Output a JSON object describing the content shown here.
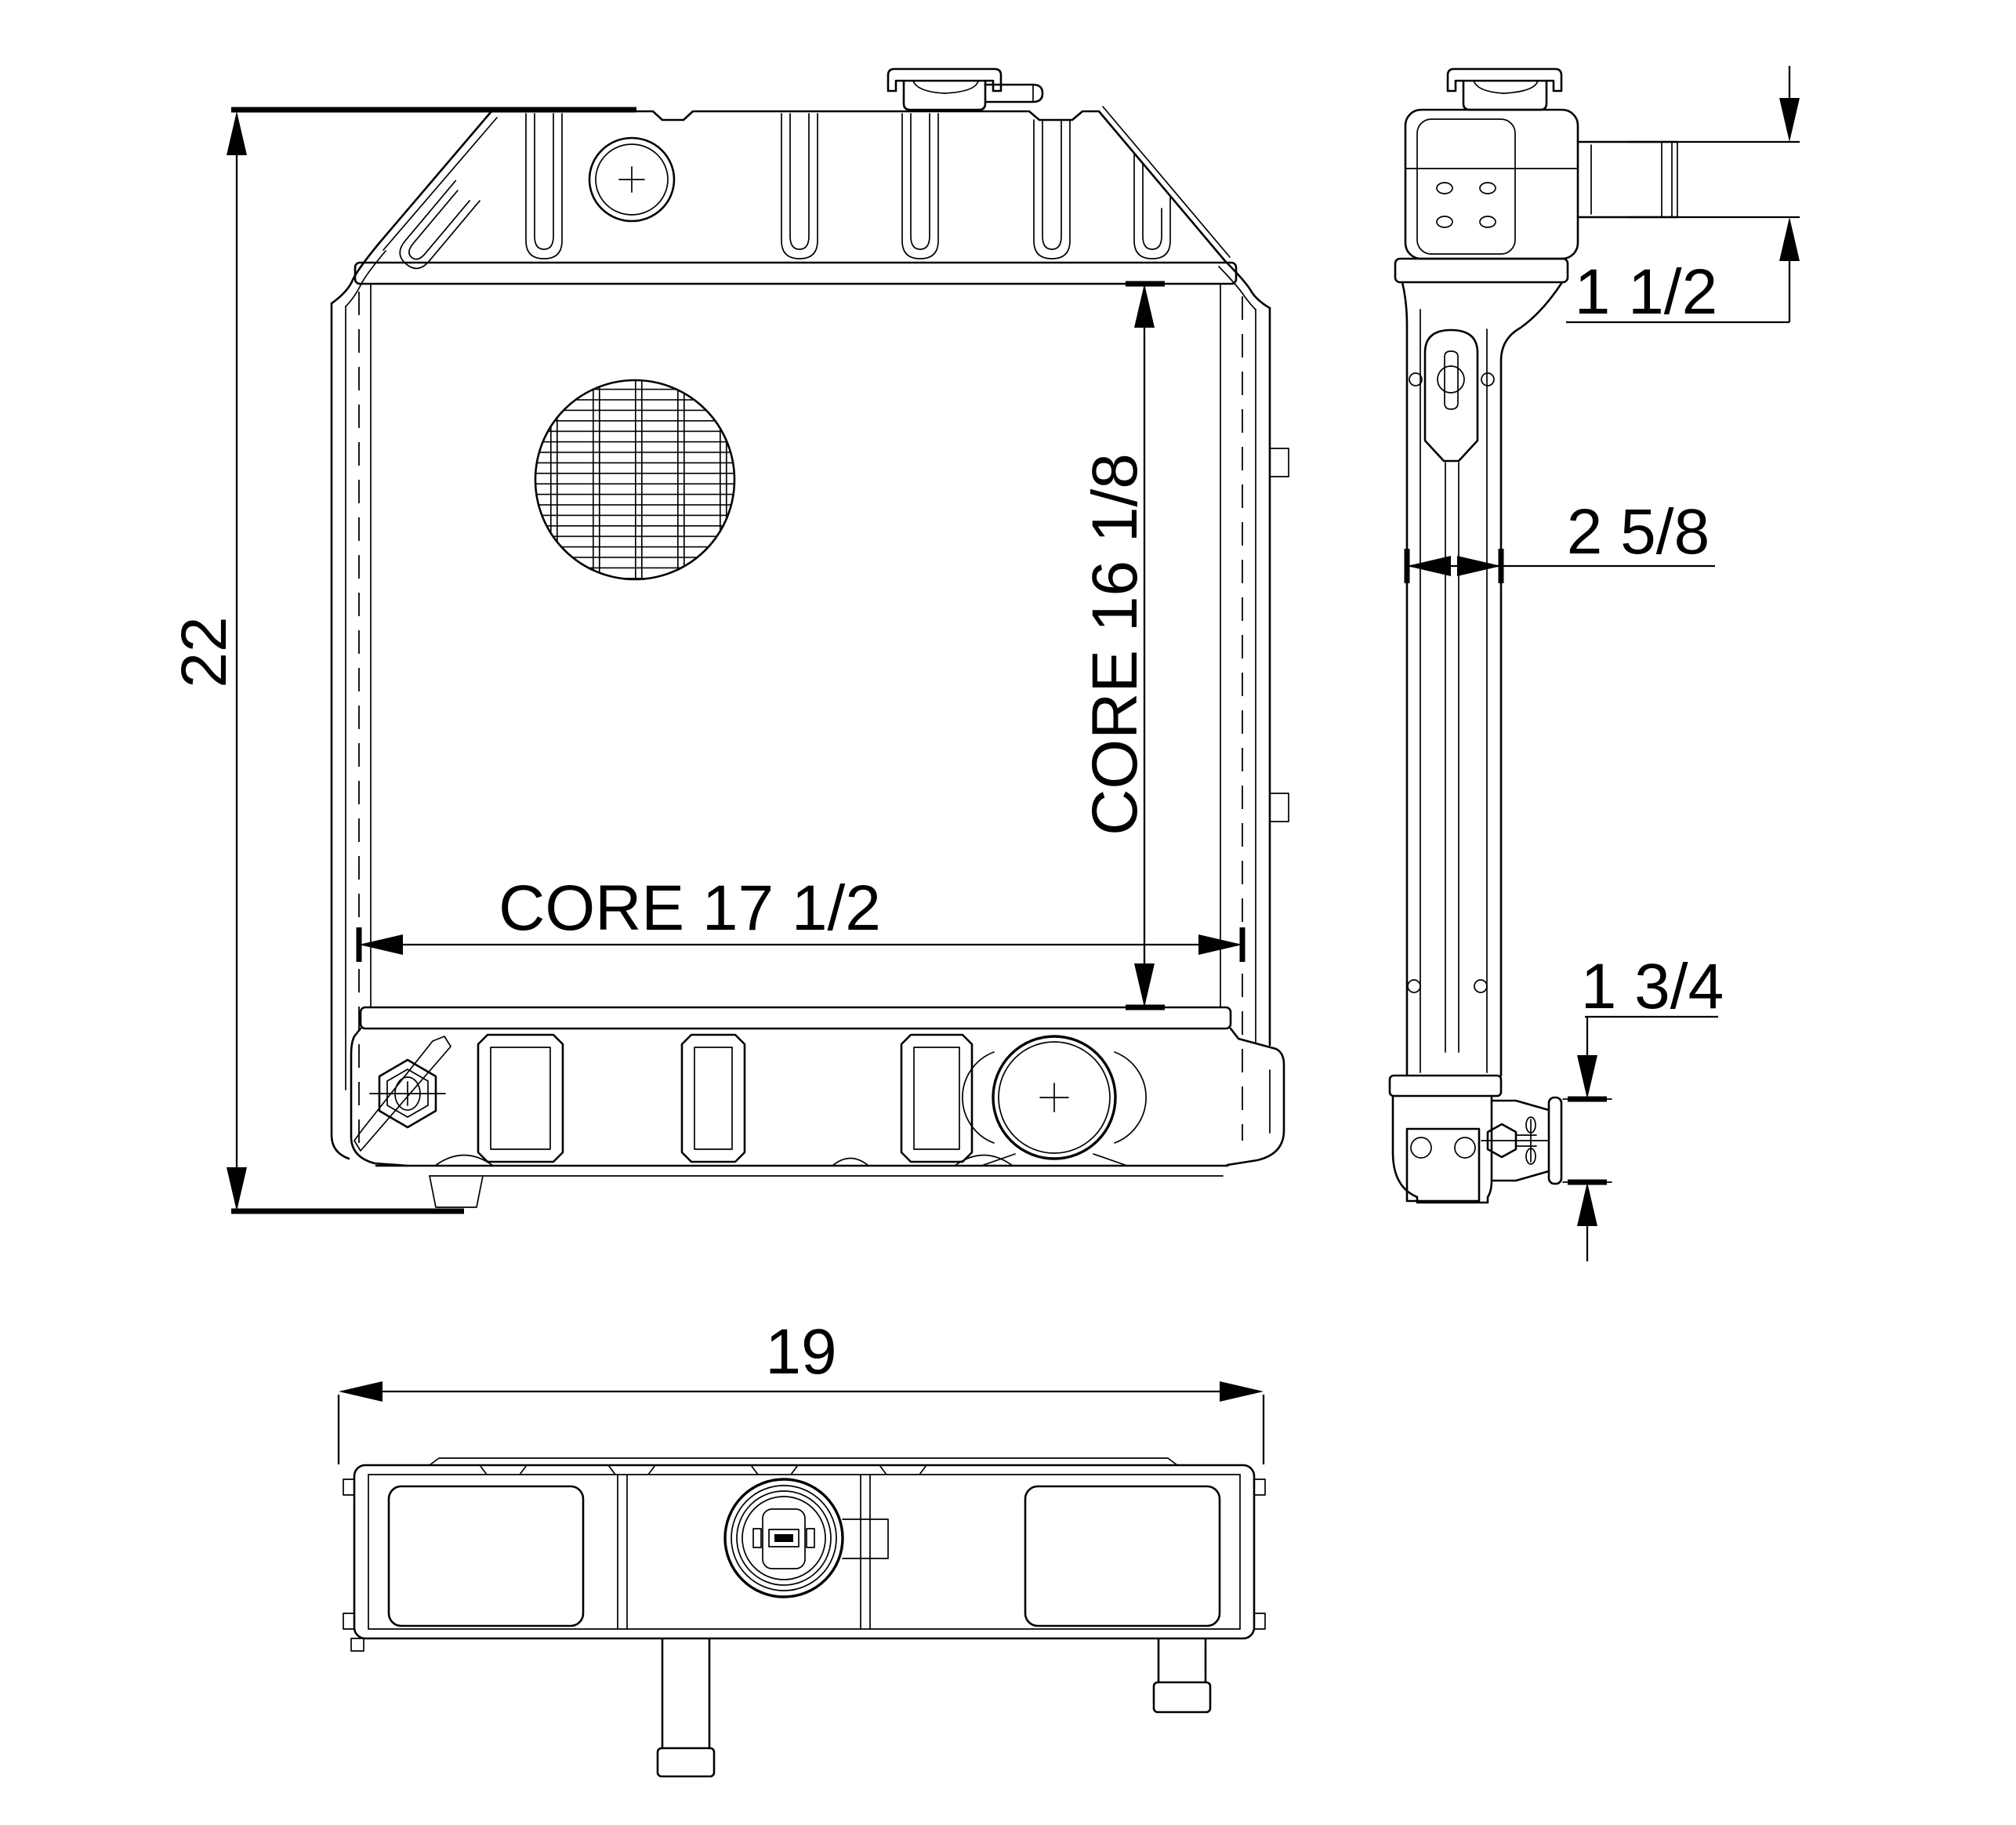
{
  "colors": {
    "line": "#000000",
    "background": "#ffffff"
  },
  "dimensions": {
    "overall_height": "22",
    "core_height": "CORE 16 1/8",
    "core_width": "CORE 17 1/2",
    "upper_outlet": "1 1/2",
    "core_depth": "2 5/8",
    "lower_outlet": "1 3/4",
    "overall_width": "19"
  }
}
